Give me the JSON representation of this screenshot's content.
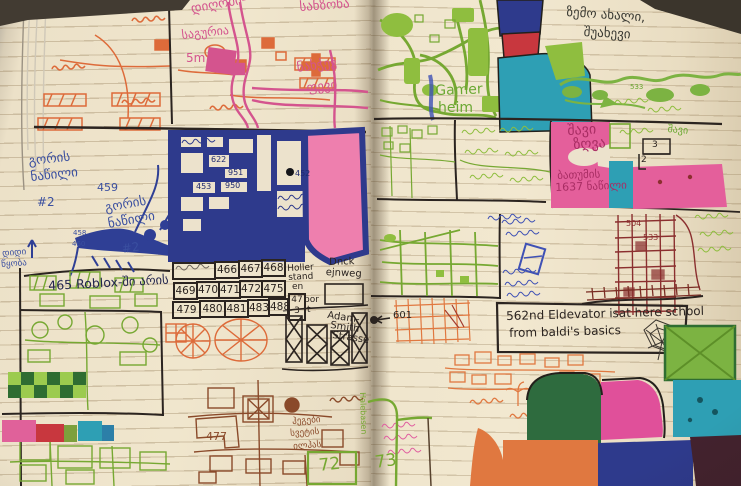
{
  "scene": {
    "description": "Photo of an open ruled notebook with a child's hand-drawn marker-coloured city maps",
    "accent_colors": {
      "navy": "#2e3a8c",
      "pink_block": "#ee7fae",
      "magenta_ink": "#d4548e",
      "orange": "#e07840",
      "green": "#76a832",
      "teal": "#2e9fb4",
      "red": "#c8373e",
      "brown": "#8a4a2a",
      "sea_pink": "#e45f9b"
    }
  },
  "left_page": {
    "pink_labels": {
      "dighomi": "დიღომი-",
      "saguria": "საგურია",
      "five_m": "5m",
      "sanzona": "სანზონა",
      "nakhchev": "ნახჭევ",
      "chevi": "ფევი"
    },
    "blue_labels": {
      "gori_1a": "გორის",
      "gori_1b": "ნაწილი",
      "gori_1c": "#2",
      "num_459": "459",
      "gori_2a": "გორის",
      "gori_2b": "ნაწილი",
      "gori_2c": "#2",
      "num_458": "458",
      "num_460": "460",
      "didi_a": "დიდი",
      "didi_b": "წყობა"
    },
    "roblox_note": "465 Roblox-ში არის",
    "navy_block_numbers": {
      "n622": "622",
      "n951": "951",
      "n950": "950",
      "n453": "453",
      "n452": "452"
    },
    "number_grid": {
      "row1": [
        "466",
        "467",
        "468"
      ],
      "row2": [
        "469",
        "470",
        "471",
        "472",
        "475"
      ],
      "row3": [
        "479",
        "480",
        "481",
        "483",
        "488"
      ]
    },
    "street_labels": {
      "holler_1": "Holler",
      "holler_2": "stand",
      "holler_3": "en",
      "por": "por",
      "t": "t",
      "cell_47": "47",
      "cell_3": "3",
      "duck_1": "Dnck",
      "duck_2": "ejnweg",
      "adam_1": "Adam-",
      "adam_2": "Smith",
      "adam_3": "Strasse"
    },
    "brown_labels": {
      "num_477": "477",
      "line1": "ჰეგები",
      "line2": "სვეტის",
      "line3": "ილჰას"
    },
    "green_vertical_label": "Halebasen",
    "page_number": "72"
  },
  "right_page": {
    "top_caption_line1": "ზემო ახალი,",
    "top_caption_line2": "შუახევი",
    "gamer_line1": "Gamer",
    "gamer_line2": "heim",
    "river_number": "533",
    "black_sea_line1": "შავი",
    "black_sea_line2": "ზღვა",
    "batumi_line1": "ბათუმის",
    "batumi_line2": "1637 ნაწილი",
    "shavi_green": "შავი",
    "fraction_top": "3",
    "fraction_bottom": "2",
    "grid_number_a": "504",
    "grid_number_b": "533",
    "street_number_601": "601",
    "elevator_line1": "562nd Eldevator isat here school",
    "elevator_line2": "from baldi's basics",
    "page_number": "73"
  }
}
